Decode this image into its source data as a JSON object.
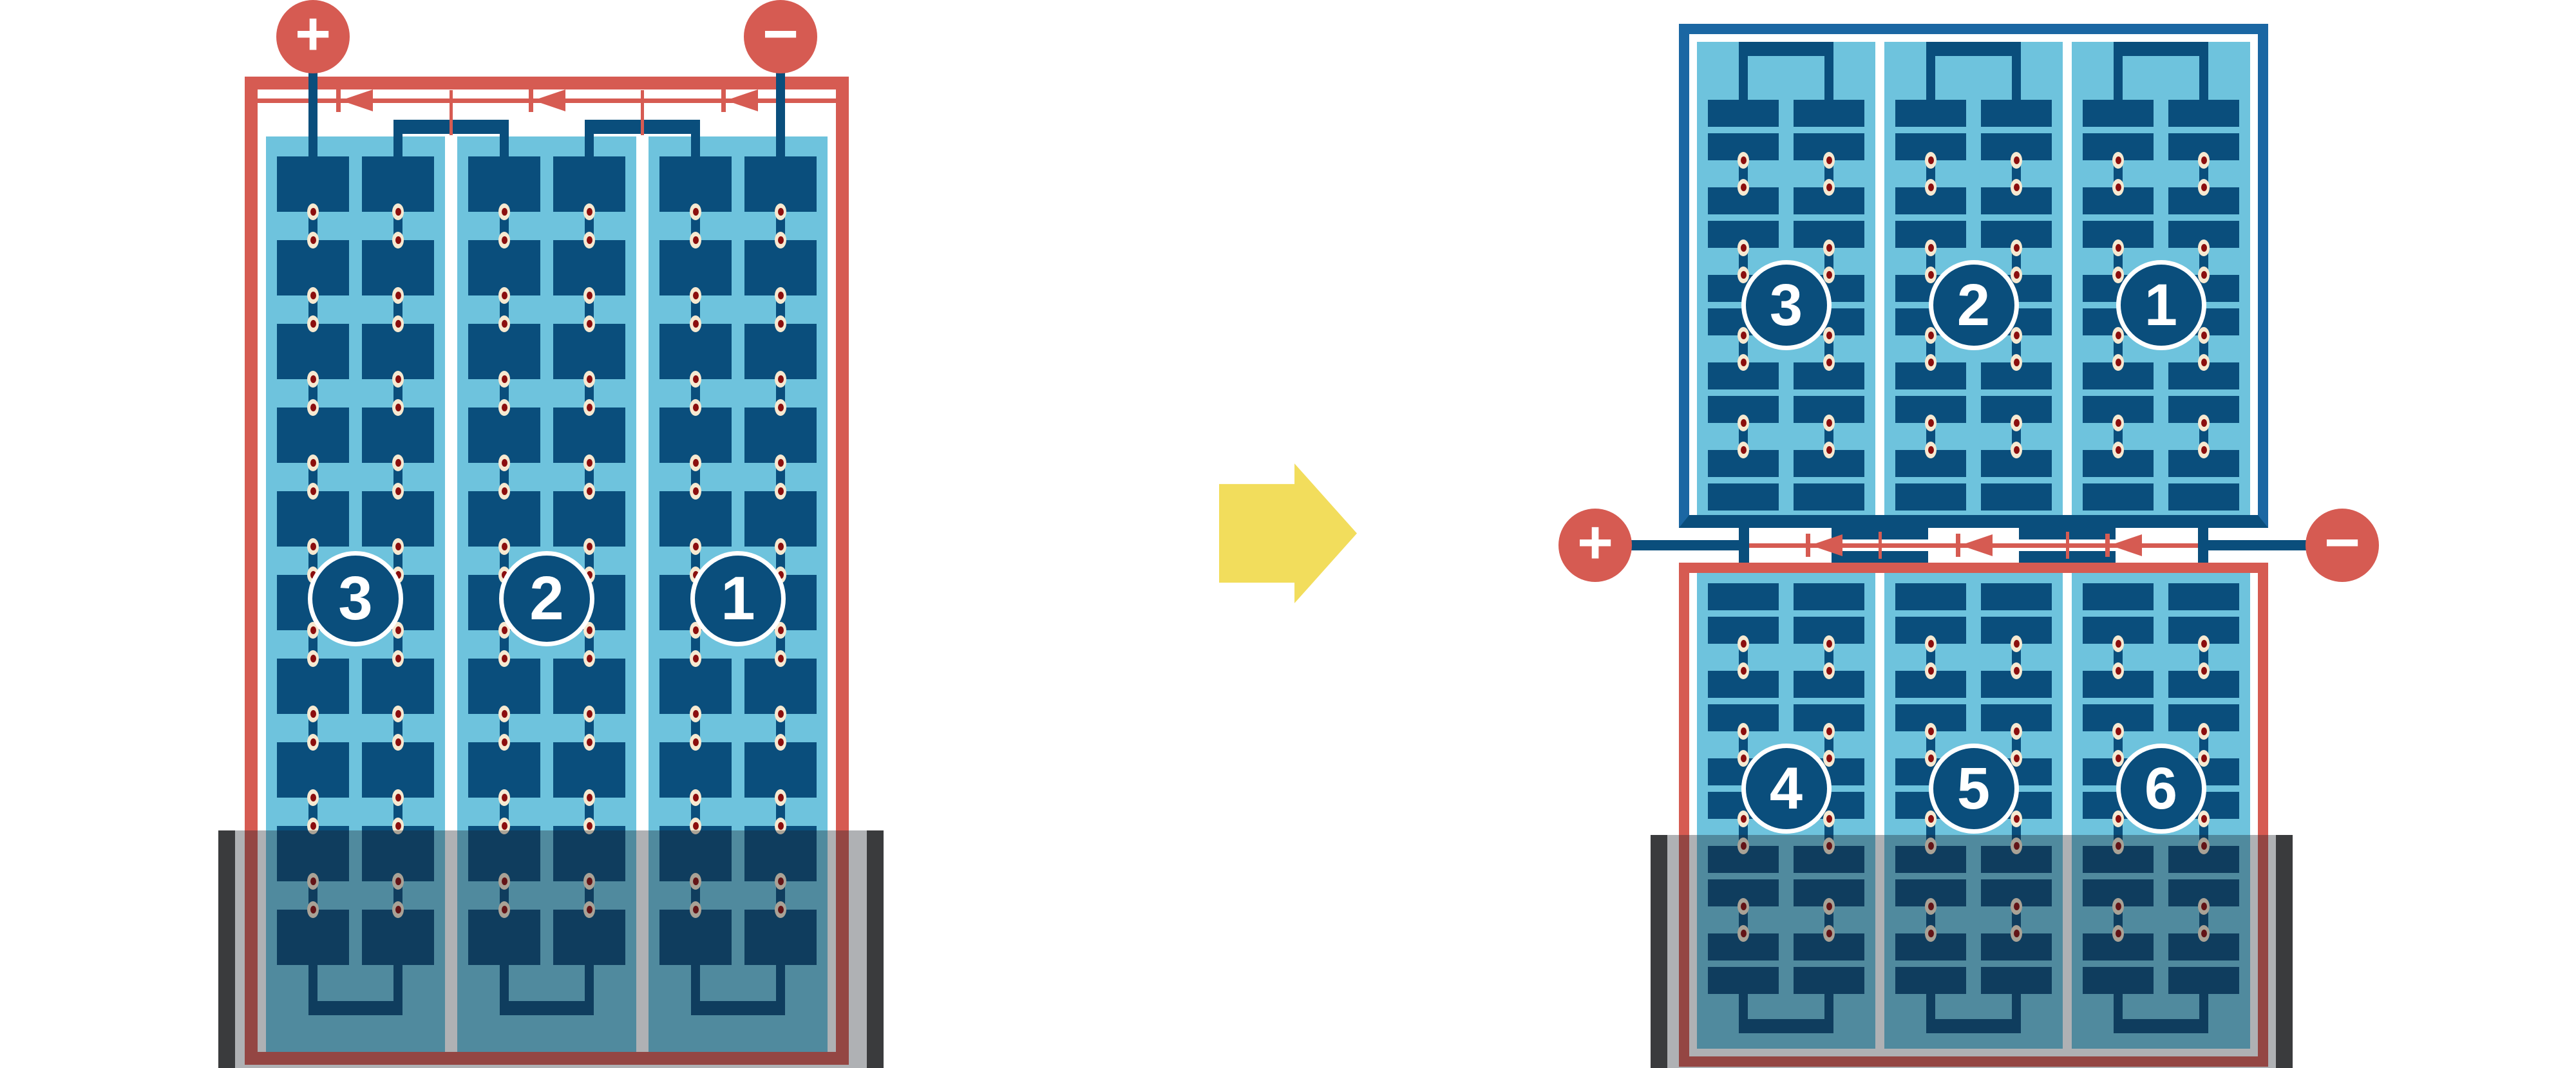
{
  "colors": {
    "accent_red": "#D65B52",
    "cell_dark_blue": "#0A4E7C",
    "module_frame_blue": "#1B67A3",
    "cell_field_light_blue": "#6EC3DD",
    "solder_dot_cream": "#F6E9D1",
    "solder_dot_red": "#8B0E0E",
    "arrow_yellow": "#F2DD5C",
    "shade_overlay": "rgba(25,32,40,0.35)",
    "overlay_end_cap": "#3A3B3D"
  },
  "left_module": {
    "terminals": {
      "positive": "+",
      "negative": "−"
    },
    "cell_group_labels": [
      "3",
      "2",
      "1"
    ]
  },
  "transform_arrow": {
    "icon": "right-block-arrow"
  },
  "right_assembly": {
    "terminals": {
      "positive": "+",
      "negative": "−"
    },
    "top_module": {
      "cell_group_labels": [
        "3",
        "2",
        "1"
      ]
    },
    "bottom_module": {
      "cell_group_labels": [
        "4",
        "5",
        "6"
      ]
    }
  }
}
